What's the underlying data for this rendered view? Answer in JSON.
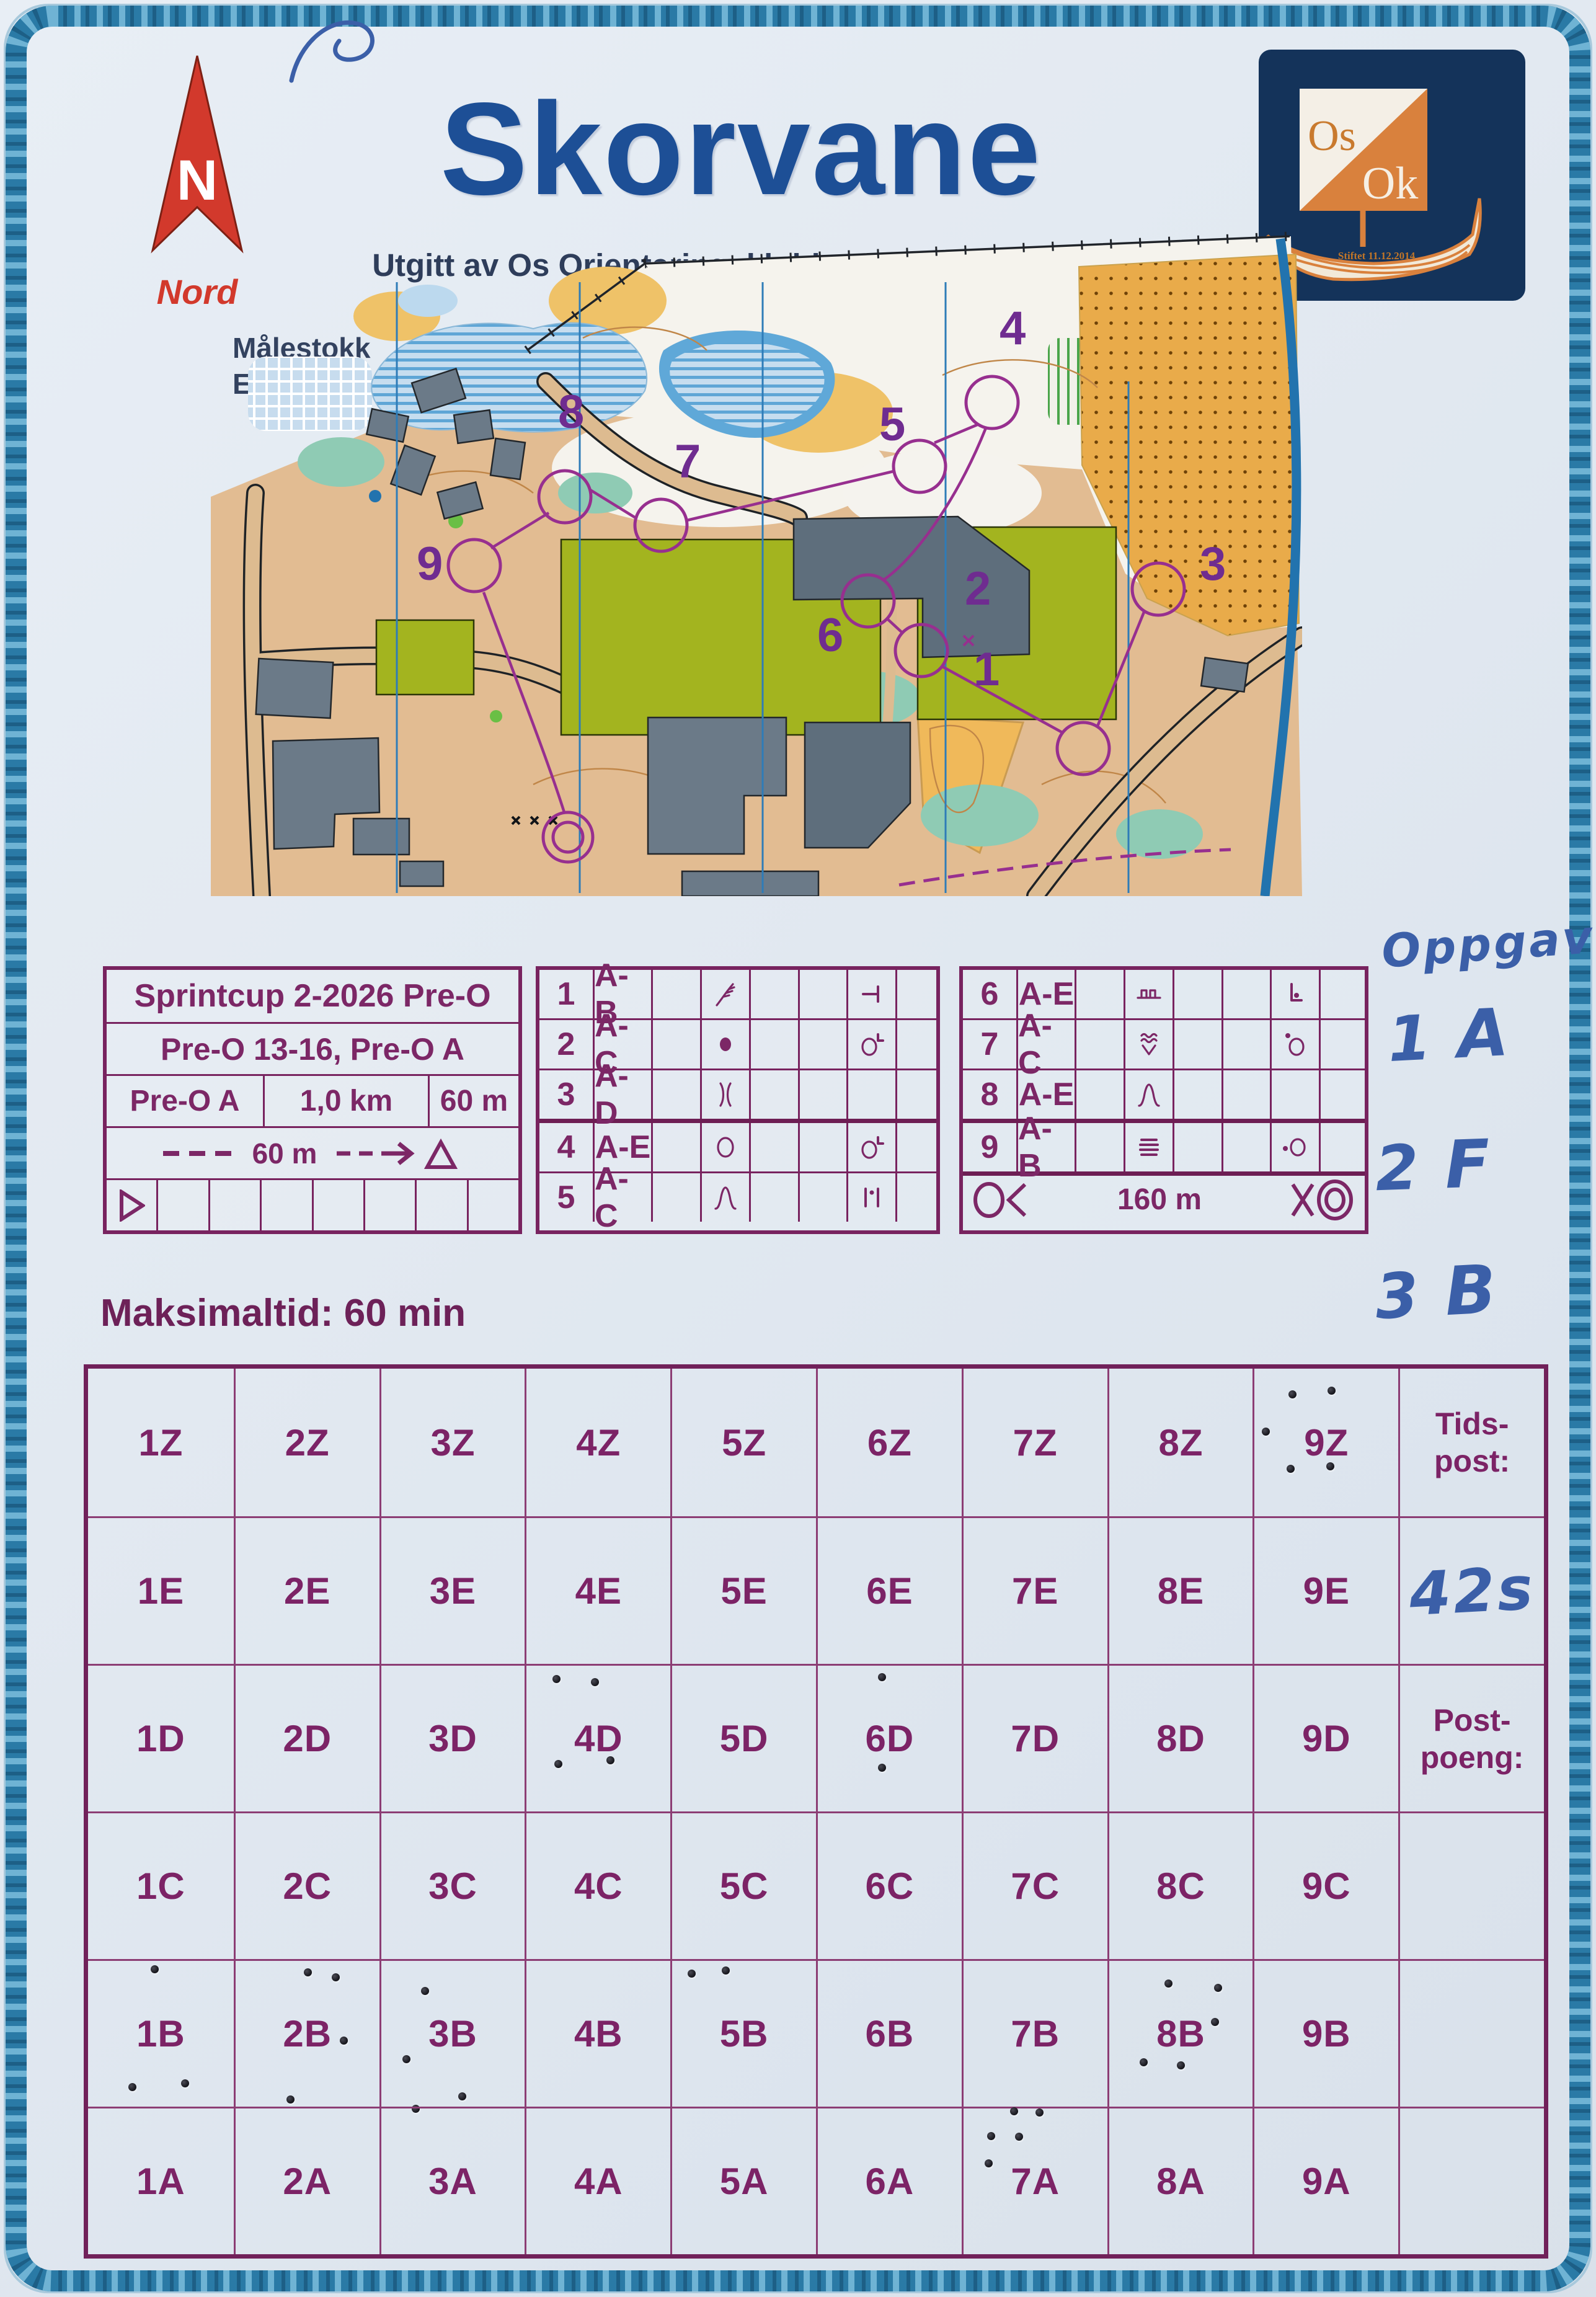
{
  "header": {
    "title": "Skorvane",
    "subtitle": "Utgitt av Os Orienteringsklubb 2026",
    "north_label": "Nord",
    "logo": {
      "top_text": "Os",
      "bottom_text": "Ok",
      "sub_text": "Stiftet 11.12.2014"
    }
  },
  "map_info": {
    "scale_label": "Målestokk",
    "scale_value": "1:4000",
    "equidistance_label": "Ekvidistanse",
    "equidistance_value": "2m",
    "control_labels": [
      "1",
      "2",
      "3",
      "4",
      "5",
      "6",
      "7",
      "8",
      "9"
    ]
  },
  "course_info": {
    "event": "Sprintcup 2-2026 Pre-O",
    "classes": "Pre-O 13-16, Pre-O A",
    "course": "Pre-O A",
    "length": "1,0 km",
    "climb": "60 m",
    "start_distance": "60 m"
  },
  "controls": [
    {
      "num": "1",
      "answers": "A-B",
      "feature": "cliff",
      "modifier": "t-bar"
    },
    {
      "num": "2",
      "answers": "A-C",
      "feature": "boulder",
      "modifier": "circle-corner"
    },
    {
      "num": "3",
      "answers": "A-D",
      "feature": "saddle",
      "modifier": ""
    },
    {
      "num": "4",
      "answers": "A-E",
      "feature": "thicket",
      "modifier": "circle-corner"
    },
    {
      "num": "5",
      "answers": "A-C",
      "feature": "hill",
      "modifier": "between-bars"
    },
    {
      "num": "6",
      "answers": "A-E",
      "feature": "wall",
      "modifier": "corner-dot"
    },
    {
      "num": "7",
      "answers": "A-C",
      "feature": "rootstock",
      "modifier": "circle-dot-top"
    },
    {
      "num": "8",
      "answers": "A-E",
      "feature": "hill",
      "modifier": ""
    },
    {
      "num": "9",
      "answers": "A-B",
      "feature": "stairway",
      "modifier": "dot-circle"
    }
  ],
  "timed_row": {
    "distance": "160 m"
  },
  "handwritten": {
    "heading": "Oppgave",
    "answers": [
      {
        "q": "1",
        "a": "A"
      },
      {
        "q": "2",
        "a": "F"
      },
      {
        "q": "3",
        "a": "B"
      }
    ],
    "time_note": "42s"
  },
  "max_time_label": "Maksimaltid: 60 min",
  "grid": {
    "columns": [
      "1",
      "2",
      "3",
      "4",
      "5",
      "6",
      "7",
      "8",
      "9"
    ],
    "rows": [
      "Z",
      "E",
      "D",
      "C",
      "B",
      "A"
    ],
    "cell_labels": [
      [
        "1Z",
        "2Z",
        "3Z",
        "4Z",
        "5Z",
        "6Z",
        "7Z",
        "8Z",
        "9Z"
      ],
      [
        "1E",
        "2E",
        "3E",
        "4E",
        "5E",
        "6E",
        "7E",
        "8E",
        "9E"
      ],
      [
        "1D",
        "2D",
        "3D",
        "4D",
        "5D",
        "6D",
        "7D",
        "8D",
        "9D"
      ],
      [
        "1C",
        "2C",
        "3C",
        "4C",
        "5C",
        "6C",
        "7C",
        "8C",
        "9C"
      ],
      [
        "1B",
        "2B",
        "3B",
        "4B",
        "5B",
        "6B",
        "7B",
        "8B",
        "9B"
      ],
      [
        "1A",
        "2A",
        "3A",
        "4A",
        "5A",
        "6A",
        "7A",
        "8A",
        "9A"
      ]
    ],
    "side_labels": {
      "row0": "Tids-\npost:",
      "row2": "Post-\npoeng:"
    },
    "punches": [
      {
        "cell": "9Z",
        "dots": [
          [
            -55,
            -78
          ],
          [
            8,
            -84
          ],
          [
            -98,
            -18
          ],
          [
            -58,
            42
          ],
          [
            6,
            38
          ]
        ]
      },
      {
        "cell": "4D",
        "dots": [
          [
            -68,
            -97
          ],
          [
            -6,
            -92
          ],
          [
            -65,
            40
          ],
          [
            19,
            34
          ]
        ]
      },
      {
        "cell": "6D",
        "dots": [
          [
            -13,
            -100
          ],
          [
            -13,
            46
          ]
        ]
      },
      {
        "cell": "1B",
        "dots": [
          [
            -10,
            -105
          ],
          [
            -46,
            85
          ],
          [
            39,
            79
          ]
        ]
      },
      {
        "cell": "2B",
        "dots": [
          [
            0,
            -100
          ],
          [
            45,
            -92
          ],
          [
            58,
            10
          ],
          [
            -28,
            105
          ]
        ]
      },
      {
        "cell": "3B",
        "dots": [
          [
            -45,
            -70
          ],
          [
            -75,
            40
          ],
          [
            -60,
            120
          ],
          [
            15,
            100
          ]
        ]
      },
      {
        "cell": "5B",
        "dots": [
          [
            -85,
            -98
          ],
          [
            -30,
            -103
          ]
        ]
      },
      {
        "cell": "8B",
        "dots": [
          [
            -20,
            -82
          ],
          [
            60,
            -75
          ],
          [
            55,
            -20
          ],
          [
            -60,
            45
          ],
          [
            0,
            50
          ]
        ]
      },
      {
        "cell": "7A",
        "dots": [
          [
            -35,
            -114
          ],
          [
            6,
            -112
          ],
          [
            -72,
            -74
          ],
          [
            -27,
            -73
          ],
          [
            -76,
            -30
          ]
        ]
      }
    ]
  },
  "colors": {
    "print_purple": "#7c2766",
    "title_blue": "#1d4f96",
    "north_red": "#d2392c",
    "ink_blue": "#3b5fa8",
    "rope_border": "#2a7aa6",
    "logo_navy": "#14335a",
    "logo_orange": "#d9813d",
    "course_purple": "#972f8f"
  }
}
